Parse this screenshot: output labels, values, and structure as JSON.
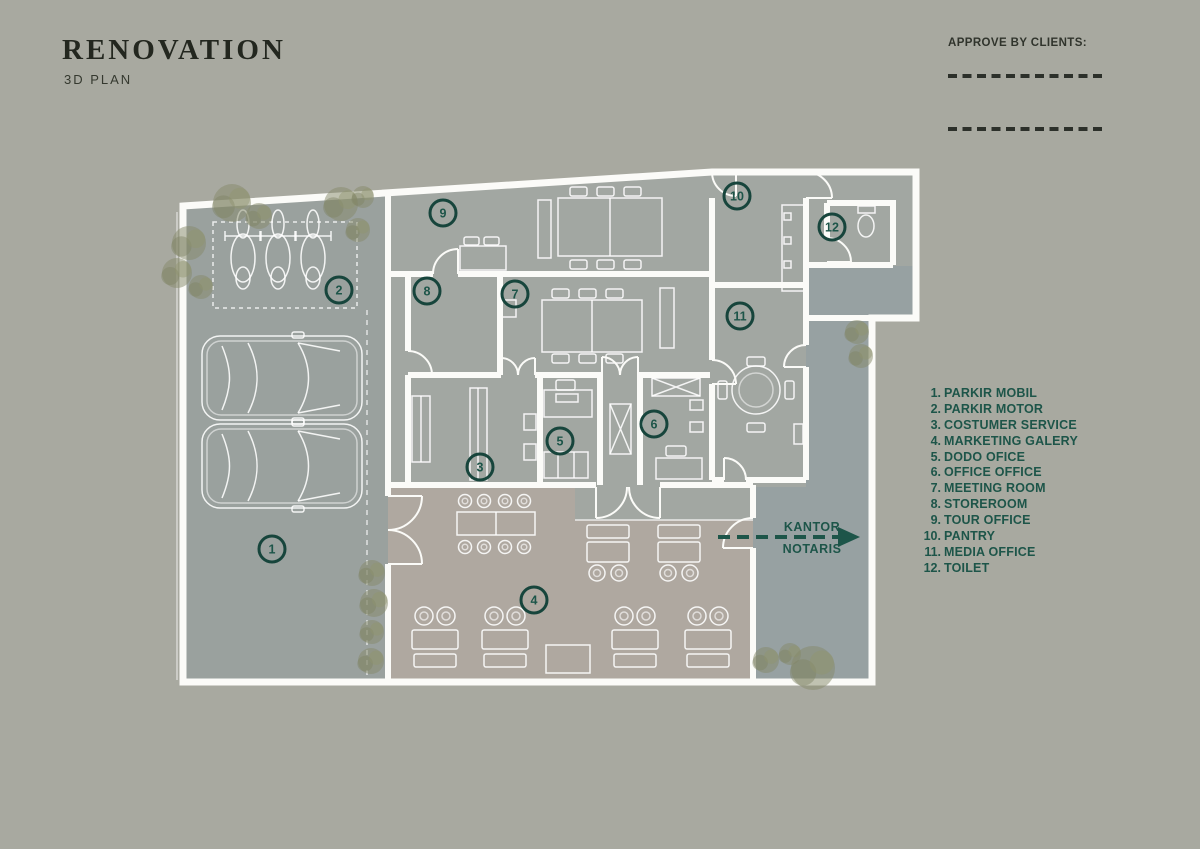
{
  "header": {
    "title": "RENOVATION",
    "subtitle": "3D PLAN"
  },
  "approval": {
    "label": "APPROVE BY CLIENTS:"
  },
  "legend": {
    "items": [
      {
        "num": "1.",
        "label": "PARKIR MOBIL"
      },
      {
        "num": "2.",
        "label": "PARKIR MOTOR"
      },
      {
        "num": "3.",
        "label": "COSTUMER SERVICE"
      },
      {
        "num": "4.",
        "label": "MARKETING GALERY"
      },
      {
        "num": "5.",
        "label": "DODO OFICE"
      },
      {
        "num": "6.",
        "label": "OFFICE OFFICE"
      },
      {
        "num": "7.",
        "label": "MEETING ROOM"
      },
      {
        "num": "8.",
        "label": "STOREROOM"
      },
      {
        "num": "9.",
        "label": "TOUR OFFICE"
      },
      {
        "num": "10.",
        "label": "PANTRY"
      },
      {
        "num": "11.",
        "label": "MEDIA OFFICE"
      },
      {
        "num": "12.",
        "label": "TOILET"
      }
    ]
  },
  "plan": {
    "markers": [
      {
        "num": "1",
        "x": 272,
        "y": 549
      },
      {
        "num": "2",
        "x": 339,
        "y": 290
      },
      {
        "num": "3",
        "x": 480,
        "y": 467
      },
      {
        "num": "4",
        "x": 534,
        "y": 600
      },
      {
        "num": "5",
        "x": 560,
        "y": 441
      },
      {
        "num": "6",
        "x": 654,
        "y": 424
      },
      {
        "num": "7",
        "x": 515,
        "y": 294
      },
      {
        "num": "8",
        "x": 427,
        "y": 291
      },
      {
        "num": "9",
        "x": 443,
        "y": 213
      },
      {
        "num": "10",
        "x": 737,
        "y": 196
      },
      {
        "num": "11",
        "x": 740,
        "y": 316
      },
      {
        "num": "12",
        "x": 832,
        "y": 227
      }
    ],
    "annotation": {
      "line1": "KANTOR",
      "line2": "NOTARIS"
    }
  },
  "colors": {
    "background": "#a8a9a0",
    "floor": "#a2a7a2",
    "parking": "#9aa19e",
    "courtyard": "#97a1a2",
    "gallery": "#afa8a0",
    "wall": "#fbfbf8",
    "accent_teal": "#1d5549",
    "marker_ring": "#17453c"
  }
}
